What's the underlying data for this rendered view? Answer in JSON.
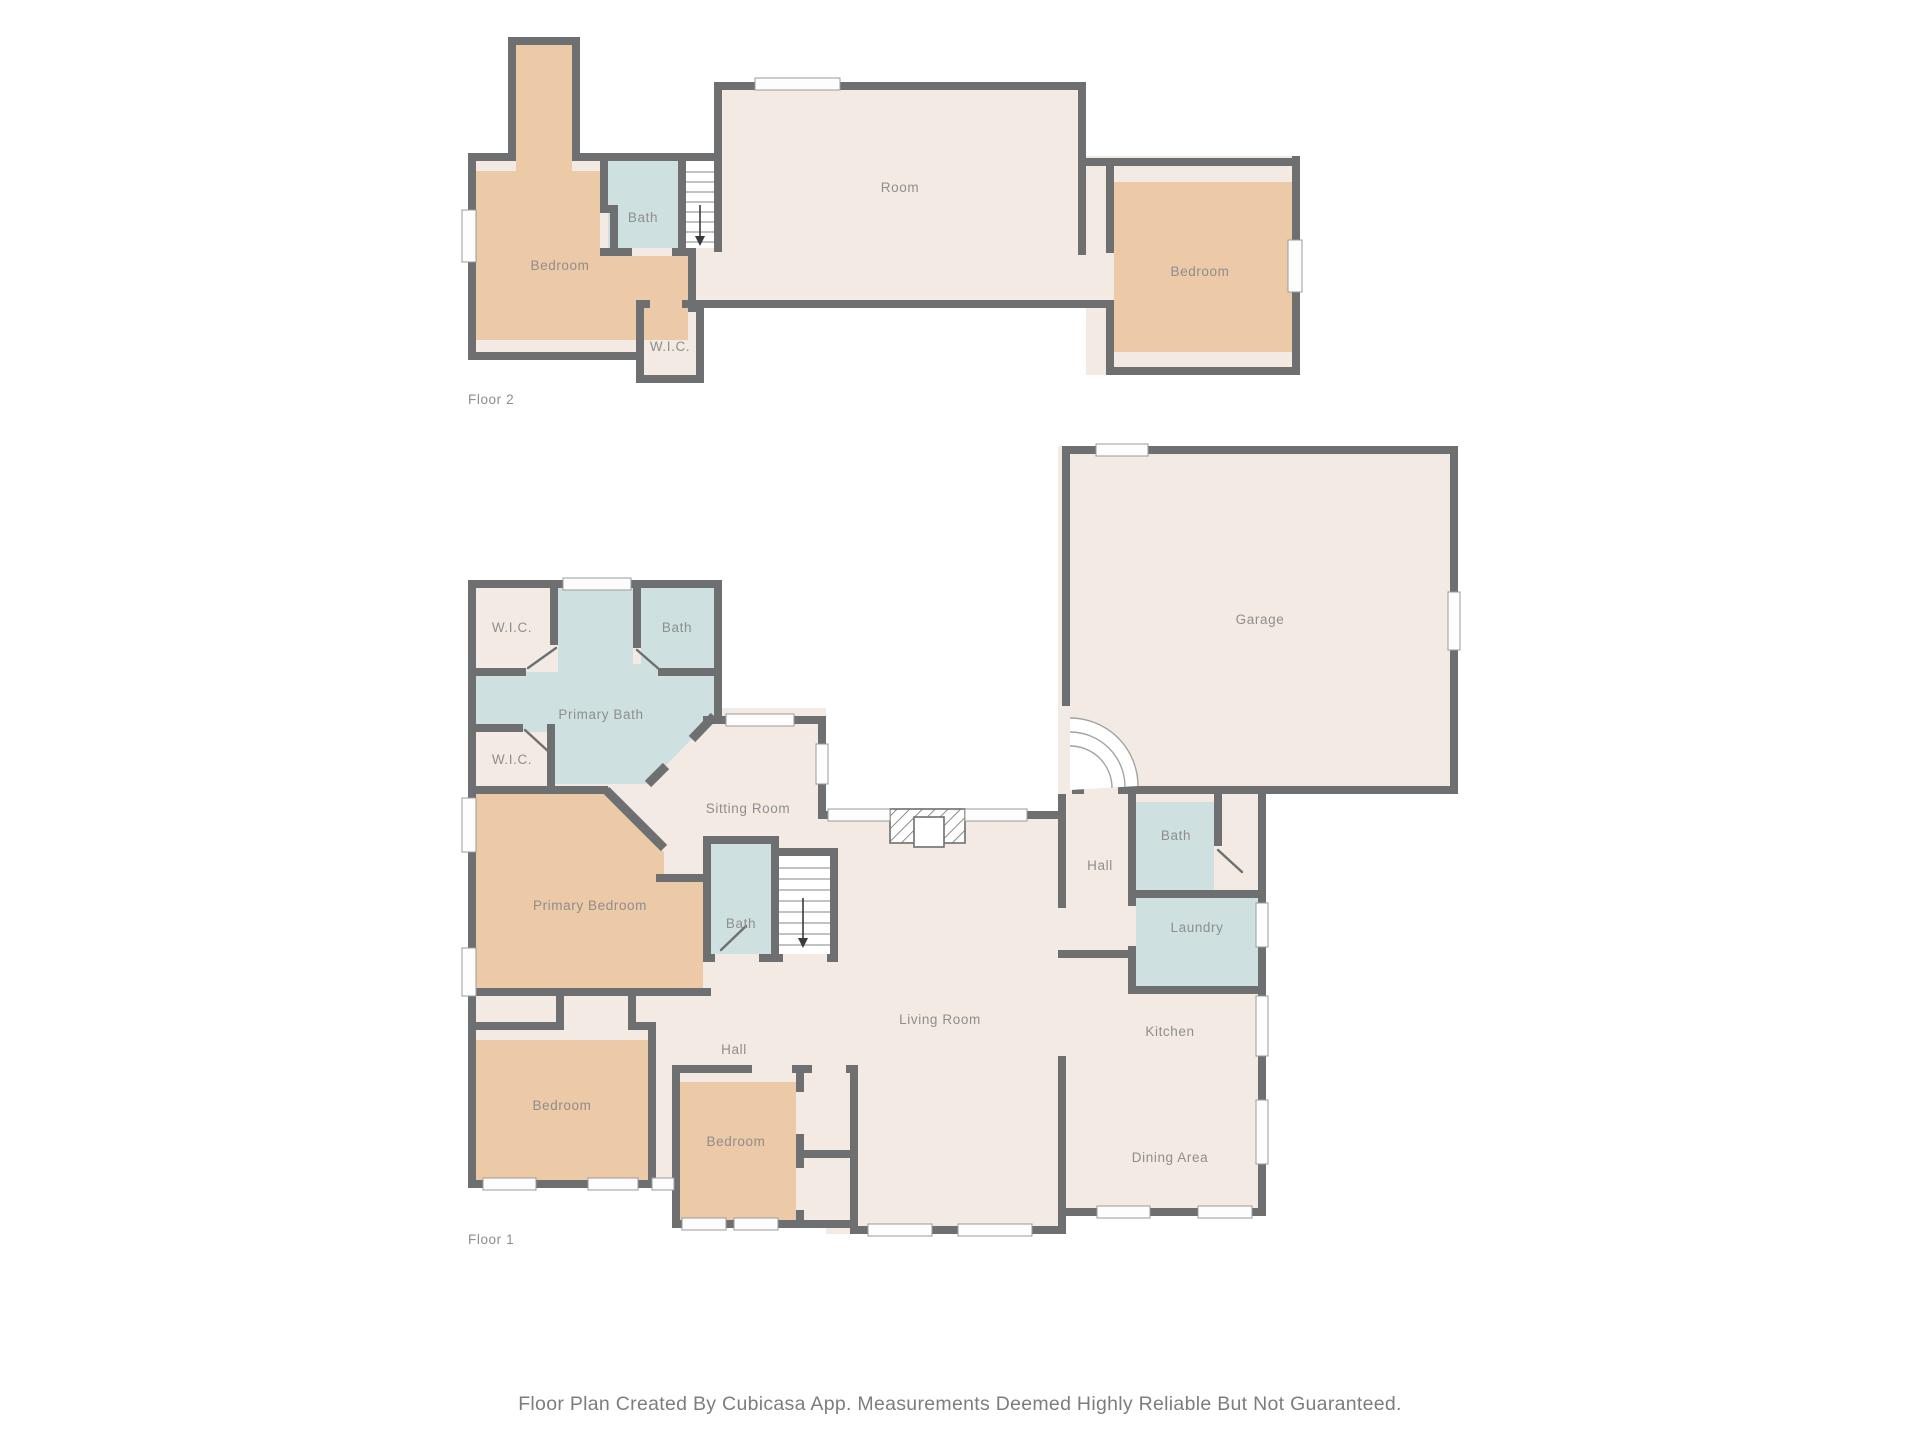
{
  "caption": "Floor Plan Created By Cubicasa App. Measurements Deemed Highly Reliable But Not Guaranteed.",
  "colors": {
    "wall": "#6d6f70",
    "floor": "#f2eae3",
    "bedroom": "#ecc9a7",
    "wet": "#cfe0e1",
    "label": "#8e8e8e",
    "caption": "#7d7d7d"
  },
  "floor2": {
    "label": "Floor 2",
    "rooms": {
      "bedroom_left": "Bedroom",
      "bath": "Bath",
      "room": "Room",
      "bedroom_right": "Bedroom",
      "wic": "W.I.C."
    }
  },
  "floor1": {
    "label": "Floor 1",
    "rooms": {
      "wic_top": "W.I.C.",
      "bath_top": "Bath",
      "primary_bath": "Primary Bath",
      "wic_mid": "W.I.C.",
      "sitting": "Sitting Room",
      "primary_bedroom": "Primary Bedroom",
      "bath_mid": "Bath",
      "hall_bottom": "Hall",
      "bedroom_left": "Bedroom",
      "bedroom_mid": "Bedroom",
      "living": "Living Room",
      "garage": "Garage",
      "hall_east": "Hall",
      "bath_east": "Bath",
      "laundry": "Laundry",
      "kitchen": "Kitchen",
      "dining": "Dining Area"
    }
  }
}
